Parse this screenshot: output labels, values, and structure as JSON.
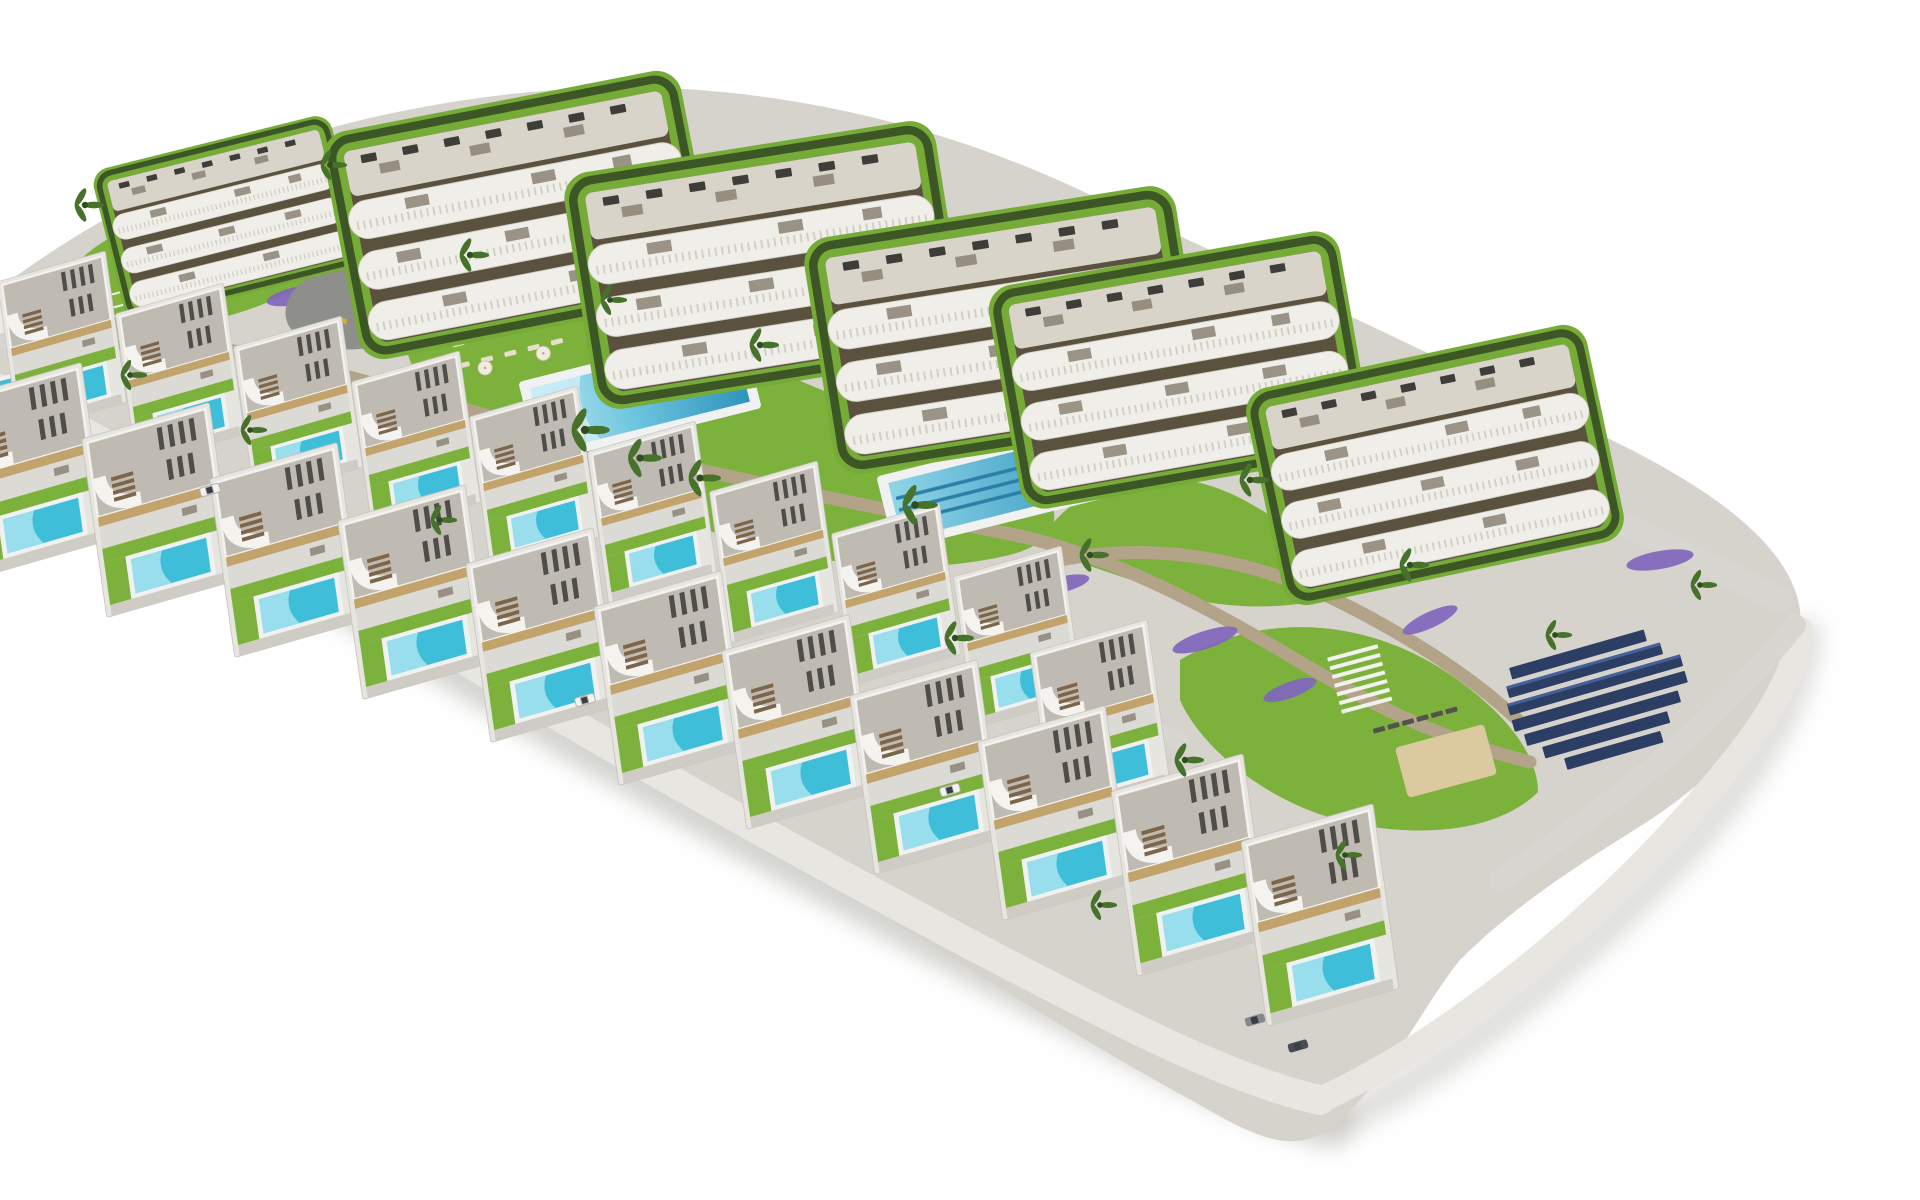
{
  "meta": {
    "title": "Aerial 3D architectural rendering of a hillside residential resort: six white apartment blocks with wavy balconies at the top, two terraced rows of flat-roof villas with private turquoise pools below, communal pools, lawns, lavender beds, stone retaining walls, palm trees and a solar panel array, on a pure white background",
    "type": "architectural-visualization-render",
    "background": "#ffffff"
  },
  "scene": {
    "apartment_buildings": {
      "count": 6,
      "floors": 4,
      "style": "white curved wavy balcony bands with slatted railings, dark recessed facades, rooftop terraces with AC units, ringed by dark green hedges and lawn"
    },
    "villas": {
      "count": 21,
      "rows": 2,
      "style": "flat gravel roofs with dark roof-top sun loungers, white curved canopy over brown entrance stairs, tan fascia, small lawn, private turquoise pool, gray driveway"
    },
    "communal": {
      "main_pool": {
        "shape": "rectangular",
        "deck": "white"
      },
      "lap_pool": {
        "lanes": 3
      },
      "playground_plaza": true,
      "sun_deck": {
        "parasols": 5,
        "loungers": 15
      },
      "pergola": true,
      "petanque_sand_court": true,
      "dark_loungers": 6,
      "solar_array_rows": 7,
      "amenity_building": 1
    },
    "landscape": {
      "palm_trees": 21,
      "lavender_beds": 16,
      "stone_retaining_walls": 4,
      "terraced_grass_steps": 3,
      "lawns": "bright green organic patches",
      "cars": 5
    }
  },
  "palette": {
    "background": "#ffffff",
    "terrain": "#d5d3cc",
    "road": "#d8d6d0",
    "perimeter": "#e8e6e1",
    "plaza": "#8e8e8a",
    "lawn": "#7cb13c",
    "hedge": "#3c5626",
    "stone": "#b3a489",
    "stone_shadow": "#93845f",
    "building_white": "#efeee8",
    "facade_shadow": "#5a523f",
    "roof_slab": "#d8d4ca",
    "villa_roof": "#bfbbb2",
    "villa_accent": "#c2a36b",
    "pool_shallow": "#b9e6f2",
    "pool_deep": "#2f93bc",
    "villa_pool": "#3fbeda",
    "lavender": "#8166bd",
    "solar": "#2c3e63",
    "sand": "#dbc9a0",
    "shadow": "#97958f",
    "palm": "#47722c",
    "stair_wood": "#7d654a"
  }
}
